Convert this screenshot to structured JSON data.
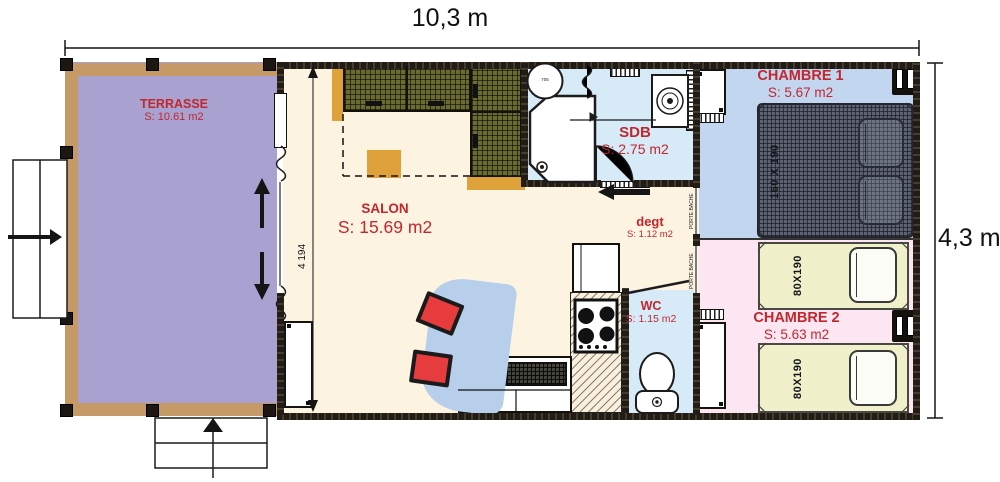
{
  "plan": {
    "dimensions": {
      "overall_width": "10,3 m",
      "overall_depth": "4,3 m",
      "interior_depth_mm": "4 194"
    },
    "rooms": {
      "terrasse": {
        "name": "TERRASSE",
        "area": "S: 10.61 m2"
      },
      "salon": {
        "name": "SALON",
        "area": "S: 15.69 m2"
      },
      "sdb": {
        "name": "SDB",
        "area": "S: 2.75 m2"
      },
      "degt": {
        "name": "degt",
        "area": "S: 1.12 m2"
      },
      "wc": {
        "name": "WC",
        "area": "S: 1.15 m2"
      },
      "chambre1": {
        "name": "CHAMBRE 1",
        "area": "S: 5.67 m2",
        "bed_size": "160 X 190"
      },
      "chambre2": {
        "name": "CHAMBRE 2",
        "area": "S: 5.63 m2",
        "bed_sizes": [
          "80X190",
          "80X190"
        ]
      }
    },
    "annotations": {
      "porte_bache_1": "PORTE BACHE",
      "porte_bache_2": "PORTE BACHE",
      "washbasin_label": "705"
    },
    "colors": {
      "terrasse": "#a9a2d0",
      "wood": "#c69a66",
      "interior": "#fdf3e1",
      "bathroom": "#d6eaf7",
      "bedroom1": "#c2d6ef",
      "bedroom2": "#fbe6f2",
      "bed_yellow": "#f0f0ca",
      "accent_red": "#c1272d",
      "cabinet_olive": "#6a6a33",
      "chair_red": "#e73c3e",
      "table_blue": "#b7cfeb",
      "wall": "#211c16"
    }
  }
}
